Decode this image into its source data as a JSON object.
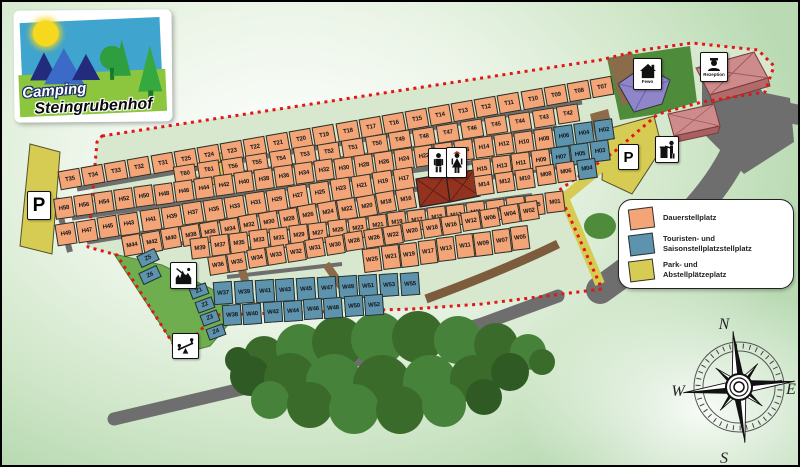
{
  "title": "Camping Steingrubenhof Platzplan",
  "logo": {
    "line1": "Camping",
    "line2": "Steingrubenhof"
  },
  "legend": {
    "items": [
      {
        "label": "Dauerstellplatz",
        "color": "#F4A577"
      },
      {
        "label": "Touristen- und\nSaisonstellplatzstellplatz",
        "color": "#5E93AE"
      },
      {
        "label": "Park- und\nAbstellplätzeplatz",
        "color": "#D6CC54"
      }
    ]
  },
  "icons": {
    "fewo": {
      "name": "holiday-apartment-icon",
      "label": "Fewo"
    },
    "reception": {
      "name": "reception-icon",
      "label": "Rezeption"
    },
    "wc_men": {
      "name": "wc-men-icon"
    },
    "wc_women": {
      "name": "wc-women-icon"
    },
    "waste": {
      "name": "waste-disposal-icon"
    },
    "parking_left": {
      "name": "parking-icon",
      "label": "P"
    },
    "parking_right": {
      "name": "parking-icon",
      "label": "P"
    },
    "playground_top": {
      "name": "playground-icon"
    },
    "playground_bottom": {
      "name": "seesaw-playground-icon"
    }
  },
  "compass": {
    "n": "N",
    "e": "E",
    "s": "S",
    "w": "W"
  },
  "colors": {
    "dauerstellplatz_orange": "#F4A577",
    "touristen_blue": "#5E93AE",
    "park_yellow": "#D6CC54",
    "boundary_red": "#E31515",
    "road_gray": "#6E6E6E",
    "field_green": "#6FAE4F"
  },
  "plots": {
    "rows": [
      {
        "id": "t-row-top",
        "color": "orange",
        "x1": 68,
        "y1": 177,
        "x2": 600,
        "y2": 85,
        "w": 22,
        "h": 19,
        "angle": -10,
        "labels": [
          "T35",
          "T34",
          "T33",
          "T32",
          "T31",
          "T25",
          "T24",
          "T23",
          "T22",
          "T21",
          "T20",
          "T19",
          "T18",
          "T17",
          "T16",
          "T15",
          "T14",
          "T13",
          "T12",
          "T11",
          "T10",
          "T09",
          "T08",
          "T07"
        ]
      },
      {
        "id": "t-row-mid",
        "color": "orange",
        "x1": 183,
        "y1": 172,
        "x2": 566,
        "y2": 112,
        "w": 22,
        "h": 18,
        "angle": -9,
        "labels": [
          "T60",
          "T61",
          "T56",
          "T55",
          "T54",
          "T53",
          "T52",
          "T51",
          "T50",
          "T49",
          "T48",
          "T47",
          "T46",
          "T45",
          "T44",
          "T43",
          "T42"
        ]
      },
      {
        "id": "h-even-row",
        "color": "orange",
        "blue": [
          "H06",
          "H04",
          "H02"
        ],
        "x1": 62,
        "y1": 206,
        "x2": 602,
        "y2": 128,
        "w": 19,
        "h": 21,
        "angle": -8,
        "labels": [
          "H58",
          "H56",
          "H54",
          "H52",
          "H50",
          "H48",
          "H46",
          "H44",
          "H42",
          "H40",
          "H38",
          "H36",
          "H34",
          "H32",
          "H30",
          "H28",
          "H26",
          "H24",
          "H22",
          "H18",
          "H16",
          "H14",
          "H12",
          "H10",
          "H08",
          "H06",
          "H04",
          "H02"
        ]
      },
      {
        "id": "h-odd-row-a",
        "color": "orange",
        "x1": 64,
        "y1": 232,
        "x2": 402,
        "y2": 177,
        "w": 20,
        "h": 22,
        "angle": -9,
        "labels": [
          "H49",
          "H47",
          "H45",
          "H43",
          "H41",
          "H39",
          "H37",
          "H35",
          "H33",
          "H31",
          "H29",
          "H27",
          "H25",
          "H23",
          "H21",
          "H19",
          "H17"
        ]
      },
      {
        "id": "h-odd-row-b",
        "color": "orange",
        "blue": [
          "H07",
          "H05",
          "H03"
        ],
        "x1": 480,
        "y1": 167,
        "x2": 598,
        "y2": 149,
        "w": 19,
        "h": 21,
        "angle": -7,
        "labels": [
          "H15",
          "H13",
          "H11",
          "H09",
          "H07",
          "H05",
          "H03"
        ]
      },
      {
        "id": "m-even-row-a",
        "color": "orange",
        "x1": 130,
        "y1": 243,
        "x2": 404,
        "y2": 197,
        "w": 19,
        "h": 21,
        "angle": -10,
        "labels": [
          "M44",
          "M42",
          "M40",
          "M38",
          "M36",
          "M34",
          "M32",
          "M30",
          "M28",
          "M26",
          "M24",
          "M22",
          "M20",
          "M18",
          "M16"
        ]
      },
      {
        "id": "m-even-row-b",
        "color": "orange",
        "blue": [
          "M04"
        ],
        "x1": 482,
        "y1": 183,
        "x2": 585,
        "y2": 167,
        "w": 19,
        "h": 20,
        "angle": -8,
        "labels": [
          "M14",
          "M12",
          "M10",
          "M08",
          "M06",
          "M04"
        ]
      },
      {
        "id": "m-odd-row",
        "color": "orange",
        "x1": 198,
        "y1": 246,
        "x2": 553,
        "y2": 200,
        "w": 19,
        "h": 21,
        "angle": -7,
        "labels": [
          "M39",
          "M37",
          "M35",
          "M33",
          "M31",
          "M29",
          "M27",
          "M25",
          "M23",
          "M21",
          "M19",
          "M17",
          "M15",
          "M13",
          "M11",
          "M09",
          "M07",
          "M05",
          "M01"
        ]
      },
      {
        "id": "w-upper-row",
        "color": "orange",
        "x1": 216,
        "y1": 263,
        "x2": 527,
        "y2": 209,
        "w": 19,
        "h": 19,
        "angle": -9,
        "labels": [
          "W36",
          "W35",
          "W34",
          "W33",
          "W32",
          "W31",
          "W30",
          "W28",
          "W26",
          "W22",
          "W20",
          "W18",
          "W16",
          "W12",
          "W06",
          "W04",
          "W02"
        ]
      },
      {
        "id": "w-lower-row",
        "color": "orange",
        "x1": 370,
        "y1": 258,
        "x2": 518,
        "y2": 236,
        "w": 18,
        "h": 24,
        "angle": -7,
        "labels": [
          "W25",
          "W21",
          "W19",
          "W17",
          "W13",
          "W11",
          "W09",
          "W07",
          "W05"
        ]
      },
      {
        "id": "w-blue-upper",
        "color": "blue",
        "x1": 221,
        "y1": 291,
        "x2": 408,
        "y2": 282,
        "w": 19,
        "h": 23,
        "angle": -4,
        "labels": [
          "W37",
          "W39",
          "W41",
          "W43",
          "W45",
          "W47",
          "W49",
          "W51",
          "W53",
          "W55"
        ]
      },
      {
        "id": "w-blue-lower",
        "color": "blue",
        "x1": 230,
        "y1": 313,
        "x2": 372,
        "y2": 303,
        "w": 19,
        "h": 21,
        "angle": -4,
        "labels": [
          "W38",
          "W40",
          "W42",
          "W44",
          "W46",
          "W48",
          "W50",
          "W52"
        ]
      },
      {
        "id": "z-left-col",
        "color": "blue",
        "x1": 146,
        "y1": 256,
        "x2": 148,
        "y2": 273,
        "w": 20,
        "h": 13,
        "angle": -25,
        "labels": [
          "Z5",
          "Z6"
        ]
      },
      {
        "id": "z-right-col",
        "color": "blue",
        "x1": 197,
        "y1": 289,
        "x2": 214,
        "y2": 330,
        "w": 18,
        "h": 12,
        "angle": -20,
        "labels": [
          "Z1",
          "Z2",
          "Z3",
          "Z4"
        ]
      }
    ]
  }
}
